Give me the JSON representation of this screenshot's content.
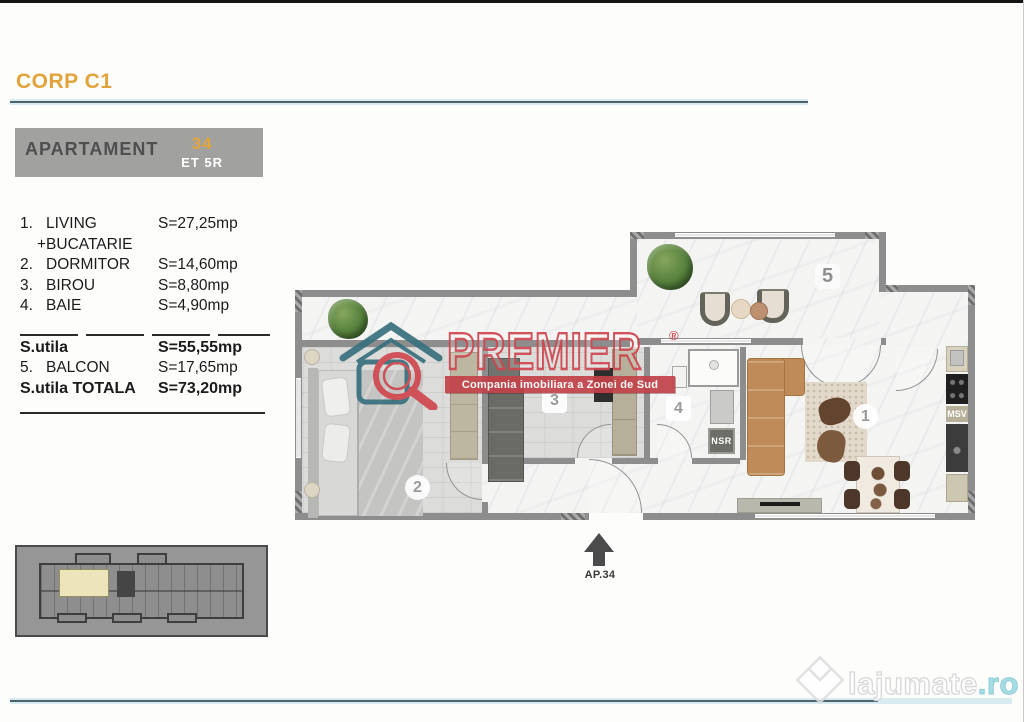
{
  "header": {
    "title": "CORP C1"
  },
  "apartment_box": {
    "label": "APARTAMENT",
    "number": "34",
    "floor": "ET 5R"
  },
  "room_list": {
    "items": [
      {
        "no": "1.",
        "name": "LIVING",
        "area": "S=27,25mp"
      },
      {
        "no": "",
        "name": "+BUCATARIE",
        "area": ""
      },
      {
        "no": "2.",
        "name": "DORMITOR",
        "area": "S=14,60mp"
      },
      {
        "no": "3.",
        "name": "BIROU",
        "area": "S=8,80mp"
      },
      {
        "no": "4.",
        "name": "BAIE",
        "area": "S=4,90mp"
      }
    ],
    "summary": [
      {
        "no": "",
        "name": "S.utila",
        "area": "S=55,55mp"
      },
      {
        "no": "5.",
        "name": "BALCON",
        "area": "S=17,65mp"
      },
      {
        "no": "",
        "name": "S.utila TOTALA",
        "area": "S=73,20mp"
      }
    ]
  },
  "floor_plan": {
    "labels": {
      "living": "1",
      "bedroom": "2",
      "office": "3",
      "bath": "4",
      "balcony": "5"
    },
    "nsr": "NSR",
    "msv": "MSV"
  },
  "watermark": {
    "brand": "PREMIER",
    "registered": "®",
    "tagline": "Compania imobiliara a Zonei de Sud"
  },
  "entrance": {
    "label": "AP.34"
  },
  "footer": {
    "site": "lajumate",
    "tld": ".ro"
  },
  "colors": {
    "accent_gold": "#E2A43A",
    "rule_teal": "#4E646C",
    "brand_red": "#C8434B",
    "wall_gray": "#8D8D8D",
    "keyplan_highlight": "#ECE5BB"
  }
}
